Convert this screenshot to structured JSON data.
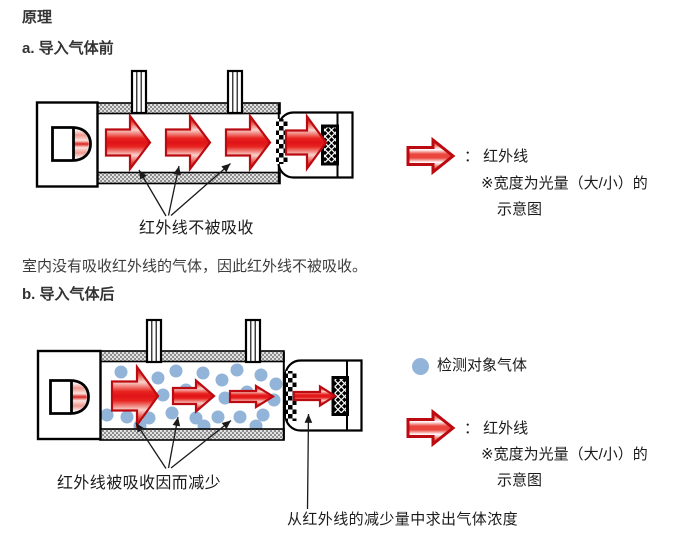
{
  "page": {
    "title": "原理",
    "section_a": {
      "heading": "a. 导入气体前",
      "caption": "红外线不被吸收"
    },
    "paragraph": "室内没有吸收红外线的气体，因此红外线不被吸收。",
    "section_b": {
      "heading": "b. 导入气体后",
      "caption": "红外线被吸收因而减少",
      "bottom_caption": "从红外线的减少量中求出气体浓度"
    },
    "legend_before": {
      "arrow_label": "： 红外线",
      "note_line1": "※宽度为光量（大/小）的",
      "note_line2": "示意图"
    },
    "legend_after": {
      "gas_label": "检测对象气体",
      "arrow_label": "： 红外线",
      "note_line1": "※宽度为光量（大/小）的",
      "note_line2": "示意图"
    },
    "colors": {
      "ir_red": "#e8241f",
      "ir_red_dark": "#bb0a10",
      "gas_blue": "#92b4d8",
      "body_text": "#3c3c3c",
      "caption_text": "#1b1b1b"
    },
    "icons": {
      "ir_arrow": "red-block-arrow-right",
      "gas_molecule": "light-blue-filled-circle"
    }
  }
}
